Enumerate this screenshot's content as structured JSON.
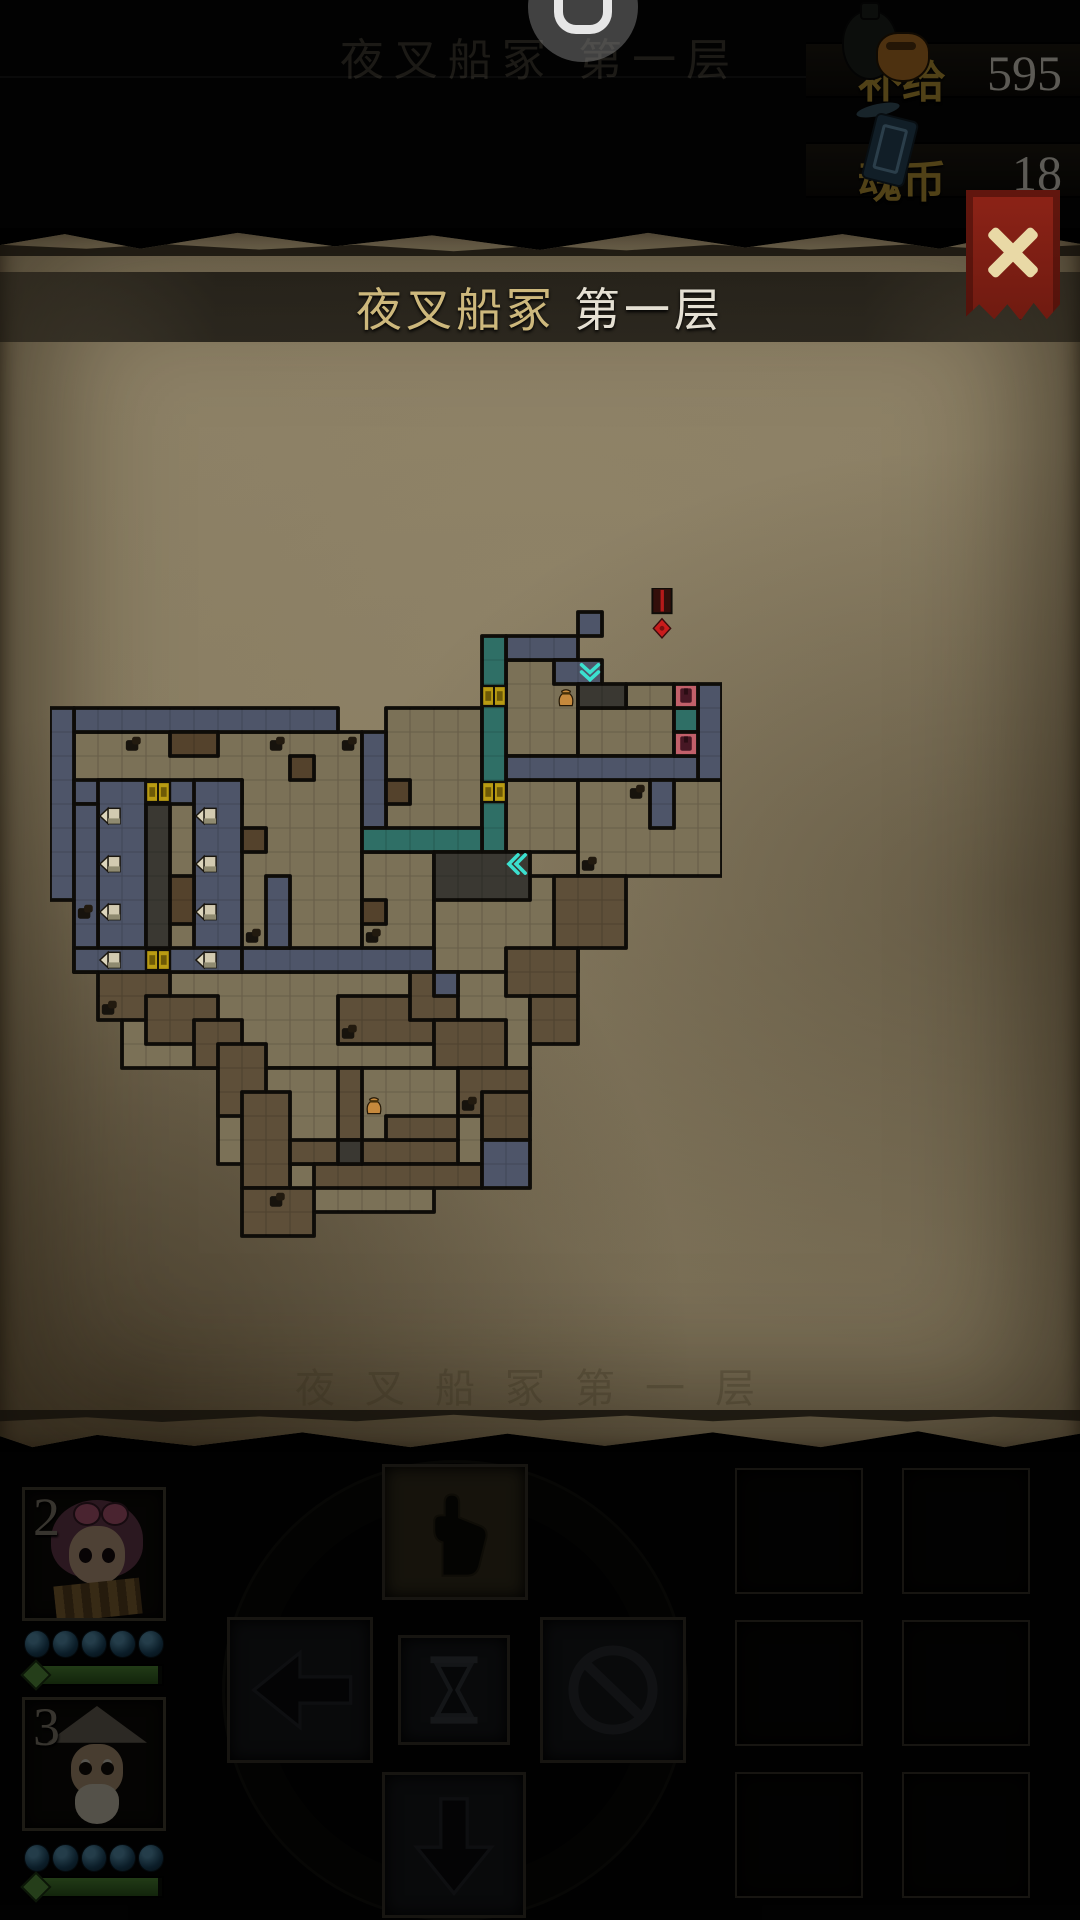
{
  "status_bar": {
    "background_title": "夜叉船冢 第一层",
    "recorder_glyph": "U",
    "resources": [
      {
        "id": "supply",
        "label": "补给",
        "value": "595",
        "icon": "supply-pouch-icon",
        "label_color": "#c8a23a"
      },
      {
        "id": "soul-coin",
        "label": "魂币",
        "value": "18",
        "icon": "soul-coin-icon",
        "label_color": "#c8a23a"
      }
    ]
  },
  "overlay": {
    "title_zone": "夜叉船冢",
    "title_floor": "第一层",
    "close_icon": "x-mark",
    "ghost_text": "夜叉船冢第一层",
    "parchment_color": "#8e8267",
    "title_band_color": "rgba(18,16,12,0.78)",
    "close_banner_color": "#8d2317"
  },
  "map": {
    "tile": 24,
    "cols": 28,
    "rows": 28,
    "origin": {
      "x": 50,
      "y": 588
    },
    "palette": {
      "f": "#7b7157",
      "b": "#4e5569",
      "t": "#2f6f66",
      "d": "#3a3832",
      "w": "#5e4f39",
      "r": "#54422c",
      "p": "#c2606a",
      "wall": "#0f0d09"
    },
    "legend": {
      "f": "floor",
      "b": "flooded-corridor",
      "t": "teal-corridor",
      "d": "dark-room",
      "w": "wooden-corridor",
      "r": "debris-patch",
      "p": "locked-door-cell"
    },
    "rects": [
      [
        "f",
        1,
        6,
        12,
        10
      ],
      [
        "f",
        14,
        5,
        4,
        6
      ],
      [
        "f",
        19,
        3,
        3,
        4
      ],
      [
        "f",
        19,
        8,
        3,
        3
      ],
      [
        "f",
        24,
        4,
        2,
        1
      ],
      [
        "f",
        22,
        5,
        4,
        2
      ],
      [
        "f",
        22,
        8,
        6,
        4
      ],
      [
        "f",
        13,
        11,
        3,
        5
      ],
      [
        "f",
        16,
        12,
        6,
        4
      ],
      [
        "f",
        3,
        16,
        17,
        4
      ],
      [
        "f",
        7,
        20,
        12,
        4
      ],
      [
        "f",
        10,
        24,
        6,
        2
      ],
      [
        "w",
        2,
        16,
        3,
        2
      ],
      [
        "w",
        4,
        17,
        3,
        2
      ],
      [
        "w",
        6,
        18,
        2,
        2
      ],
      [
        "w",
        7,
        19,
        2,
        3
      ],
      [
        "w",
        8,
        21,
        2,
        4
      ],
      [
        "w",
        8,
        25,
        3,
        2
      ],
      [
        "w",
        10,
        23,
        7,
        1
      ],
      [
        "w",
        11,
        24,
        7,
        1
      ],
      [
        "w",
        12,
        17,
        4,
        2
      ],
      [
        "w",
        15,
        16,
        2,
        2
      ],
      [
        "w",
        16,
        18,
        3,
        2
      ],
      [
        "w",
        17,
        20,
        3,
        2
      ],
      [
        "w",
        12,
        20,
        1,
        3
      ],
      [
        "w",
        14,
        22,
        3,
        1
      ],
      [
        "w",
        19,
        15,
        3,
        2
      ],
      [
        "w",
        21,
        12,
        3,
        3
      ],
      [
        "w",
        20,
        17,
        2,
        2
      ],
      [
        "w",
        18,
        21,
        2,
        2
      ],
      [
        "b",
        22,
        1,
        1,
        1
      ],
      [
        "b",
        19,
        2,
        3,
        1
      ],
      [
        "b",
        21,
        3,
        2,
        1
      ],
      [
        "b",
        27,
        4,
        1,
        4
      ],
      [
        "b",
        19,
        7,
        8,
        1
      ],
      [
        "b",
        13,
        6,
        1,
        4
      ],
      [
        "b",
        1,
        5,
        11,
        1
      ],
      [
        "b",
        0,
        5,
        1,
        8
      ],
      [
        "b",
        1,
        8,
        7,
        1
      ],
      [
        "b",
        2,
        8,
        2,
        8
      ],
      [
        "b",
        6,
        8,
        2,
        8
      ],
      [
        "b",
        1,
        9,
        1,
        7
      ],
      [
        "b",
        1,
        15,
        7,
        1
      ],
      [
        "b",
        8,
        15,
        8,
        1
      ],
      [
        "b",
        9,
        12,
        1,
        3
      ],
      [
        "b",
        16,
        16,
        1,
        1
      ],
      [
        "b",
        18,
        23,
        2,
        2
      ],
      [
        "b",
        25,
        8,
        1,
        2
      ],
      [
        "t",
        18,
        2,
        1,
        9
      ],
      [
        "t",
        13,
        10,
        5,
        1
      ],
      [
        "t",
        26,
        5,
        1,
        1
      ],
      [
        "d",
        22,
        4,
        2,
        1
      ],
      [
        "d",
        16,
        11,
        4,
        2
      ],
      [
        "d",
        4,
        9,
        1,
        6
      ],
      [
        "d",
        12,
        23,
        1,
        1
      ],
      [
        "r",
        5,
        6,
        2,
        1
      ],
      [
        "r",
        10,
        7,
        1,
        1
      ],
      [
        "r",
        8,
        10,
        1,
        1
      ],
      [
        "r",
        5,
        12,
        1,
        2
      ],
      [
        "r",
        13,
        13,
        1,
        1
      ],
      [
        "r",
        14,
        8,
        1,
        1
      ],
      [
        "p",
        26,
        4,
        1,
        1
      ],
      [
        "p",
        26,
        6,
        1,
        1
      ]
    ],
    "icons": [
      [
        "boss",
        25,
        0
      ],
      [
        "gate",
        18,
        4
      ],
      [
        "gate",
        18,
        8
      ],
      [
        "gate",
        4,
        8
      ],
      [
        "gate",
        4,
        15
      ],
      [
        "bed",
        2,
        9
      ],
      [
        "bed",
        2,
        11
      ],
      [
        "bed",
        2,
        13
      ],
      [
        "bed",
        2,
        15
      ],
      [
        "bed",
        6,
        9
      ],
      [
        "bed",
        6,
        11
      ],
      [
        "bed",
        6,
        13
      ],
      [
        "bed",
        6,
        15
      ],
      [
        "door",
        26,
        4
      ],
      [
        "door",
        26,
        6
      ],
      [
        "chevron-down",
        22,
        3
      ],
      [
        "chevron-left",
        19,
        11
      ],
      [
        "pouch",
        21,
        4
      ],
      [
        "pouch",
        13,
        21
      ],
      [
        "enemy",
        3,
        6
      ],
      [
        "enemy",
        9,
        6
      ],
      [
        "enemy",
        12,
        6
      ],
      [
        "enemy",
        1,
        13
      ],
      [
        "enemy",
        8,
        14
      ],
      [
        "enemy",
        13,
        14
      ],
      [
        "enemy",
        2,
        17
      ],
      [
        "enemy",
        12,
        18
      ],
      [
        "enemy",
        24,
        8
      ],
      [
        "enemy",
        22,
        11
      ],
      [
        "enemy",
        17,
        21
      ],
      [
        "enemy",
        9,
        25
      ]
    ]
  },
  "party": [
    {
      "number": "2",
      "orbs": 5,
      "hp_fill": 0.97
    },
    {
      "number": "3",
      "orbs": 5,
      "hp_fill": 0.97
    }
  ],
  "controls": {
    "buttons": [
      {
        "id": "move-up",
        "icon": "hand-up-icon",
        "highlighted": true
      },
      {
        "id": "move-left",
        "icon": "arrow-left-icon",
        "highlighted": false
      },
      {
        "id": "wait",
        "icon": "hourglass-icon",
        "highlighted": false
      },
      {
        "id": "cancel",
        "icon": "no-entry-icon",
        "highlighted": false
      },
      {
        "id": "move-down",
        "icon": "arrow-down-icon",
        "highlighted": false
      }
    ]
  },
  "inventory": {
    "slots": 6
  }
}
